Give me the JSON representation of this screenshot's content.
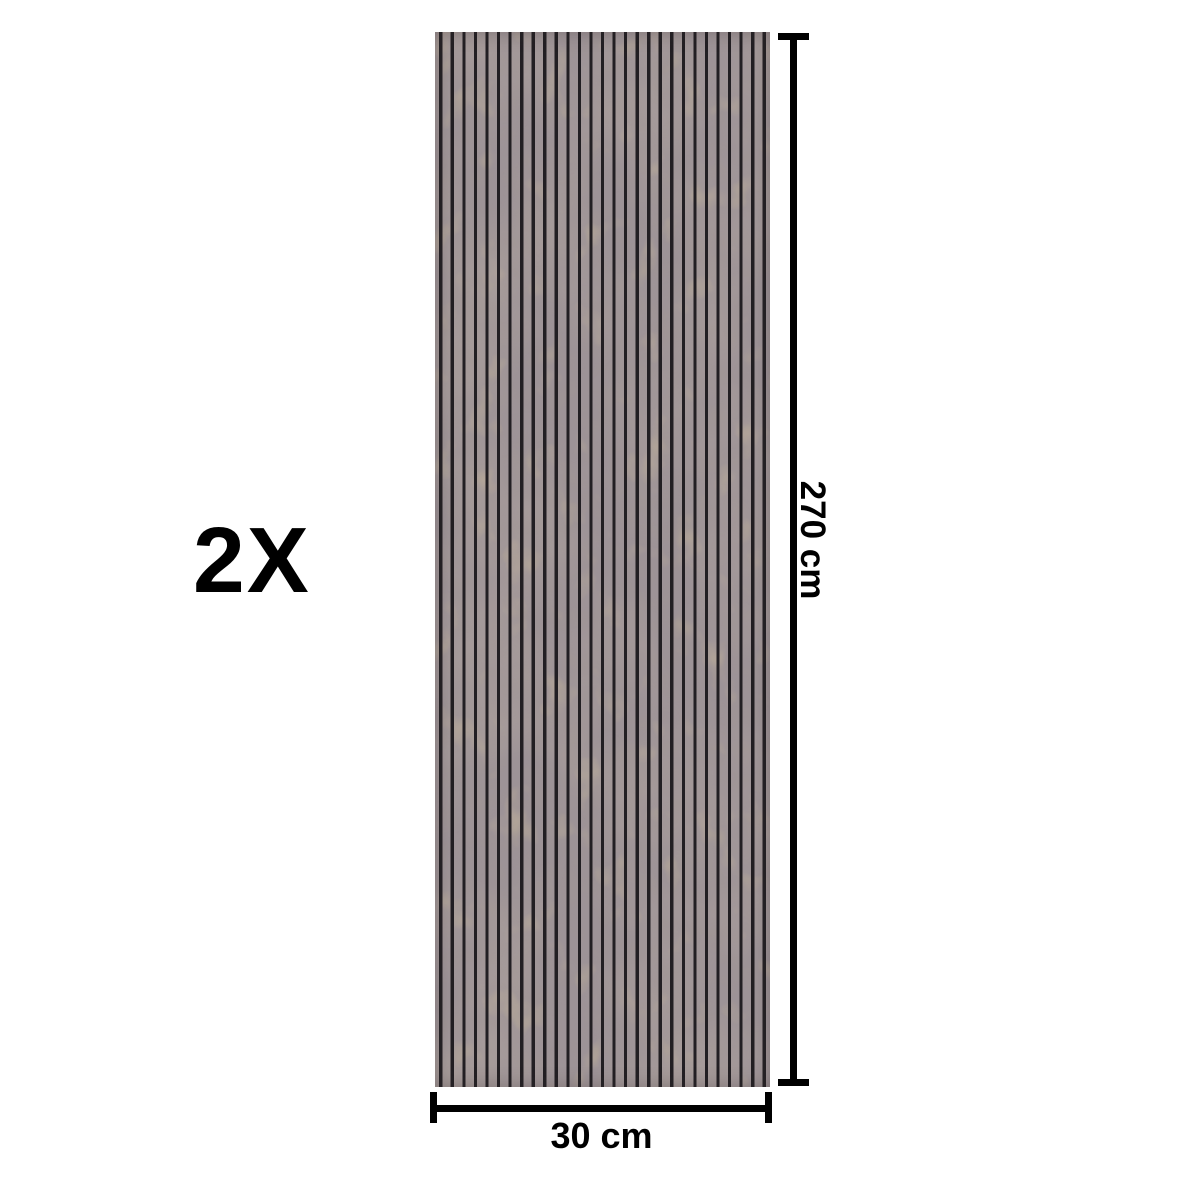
{
  "figure": {
    "quantity_label": "2X",
    "height_label": "270 cm",
    "width_label": "30 cm",
    "panel": {
      "type": "acoustic-slat-wall-panel",
      "slat_count": 29,
      "base_color": "#9d9397",
      "mottle_color": "#6e6058",
      "fleck_color": "#a98f5e",
      "slat_color": "#221f23"
    },
    "dimension_color": "#000000",
    "background_color": "#ffffff"
  }
}
